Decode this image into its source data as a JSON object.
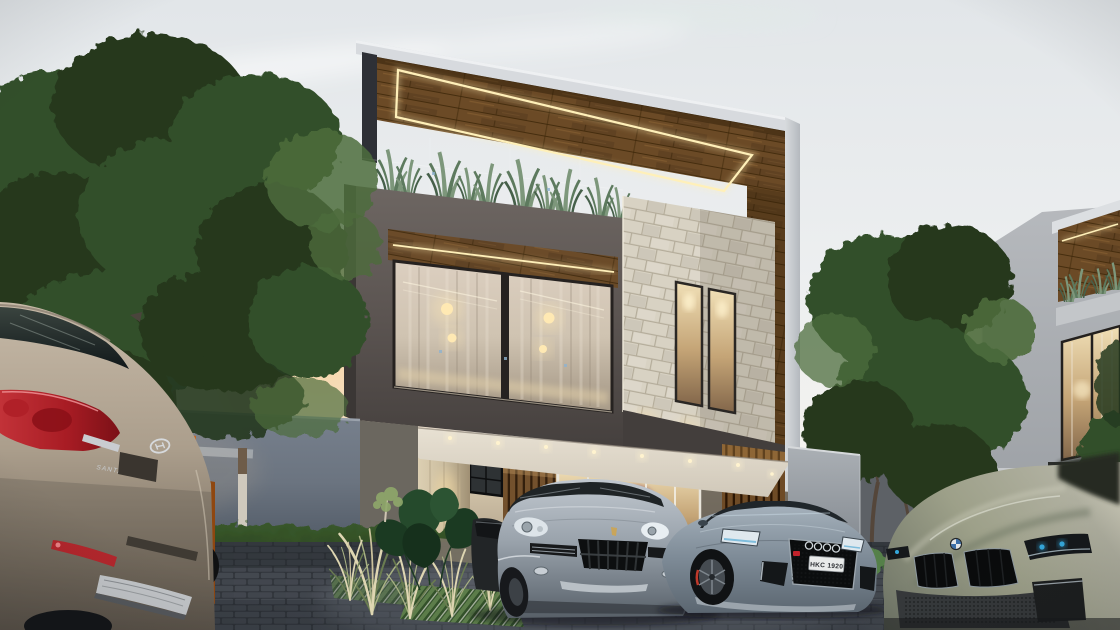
{
  "scene": {
    "title": "Modern two-storey villa exterior at dusk",
    "time_of_day": "dusk",
    "setting": "residential street, cars parked on paver driveway"
  },
  "colors": {
    "sky_top": "#e2e6e9",
    "sky_mid": "#edeff0",
    "sky_low": "#f4f2ee",
    "sunset": "#f8d29e",
    "tree_dark": "#26391f",
    "tree_mid": "#33502a",
    "tree_light": "#4c6c3c",
    "wall_left": "#6b7480",
    "wall_right": "#9aa0a6",
    "wall_shadow": "#5d6166",
    "hedge": "#223618",
    "hedge_light": "#3a5a2c",
    "parapet_white": "#d7dade",
    "house_dark_volume": "#5b5451",
    "house_dark_volume_deep": "#433e3c",
    "wood": "#6b4a26",
    "wood_dark": "#49300f",
    "led": "#fff0b9",
    "stone": "#d8d2c3",
    "stone_joint": "#b4ac9a",
    "curtain": "#cfc3b1",
    "glass_warm": "#e9d8b4",
    "ceiling": "#e9e2d4",
    "travertine": "#cbbd9f",
    "slat": "#6e4b26",
    "slat_dark": "#2a1604",
    "pave": "#43484f",
    "pave_joint": "#30343a",
    "pave_light": "#6e747c",
    "santafe": "#ab9e8c",
    "taillight": "#a81c24",
    "cayenne": "#9aa3ac",
    "audi": "#7e8b97",
    "bmw": "#b0b0a0",
    "orange_car": "#c96b28",
    "plate_bg": "#e9ebea",
    "plate_text": "#2a2d31",
    "neighbor_wall": "#b6b9bd"
  },
  "house": {
    "storeys": 2,
    "features": [
      "rooftop wood pergola with warm LED strip",
      "roof terrace with snake plants behind glass railing",
      "rough stone feature column with two tall windows",
      "full-height curtained living-room windows",
      "carport ceiling with recessed downlights",
      "wood slat side wall",
      "travertine entry pillar and arched niche"
    ]
  },
  "neighborhood": {
    "left": "mature trees over grey boundary wall with sunset glow",
    "right": "matching villa with lit pergola, plants and curtained window"
  },
  "vehicles": {
    "santa_fe": {
      "name": "Hyundai Santa Fe SUV, rear view in foreground",
      "badge": "SANTA FE",
      "body_color": "#ab9e8c"
    },
    "cayenne": {
      "name": "Porsche Cayenne SUV under carport",
      "body_color": "#9aa3ac"
    },
    "audi": {
      "name": "Audi S5 sedan",
      "plate": "HKC 1920",
      "body_color": "#7e8b97"
    },
    "bmw": {
      "name": "BMW 8-Series coupe, bottom right",
      "body_color": "#b0b0a0"
    },
    "orange": {
      "name": "orange car glimpsed behind the SUV"
    }
  }
}
